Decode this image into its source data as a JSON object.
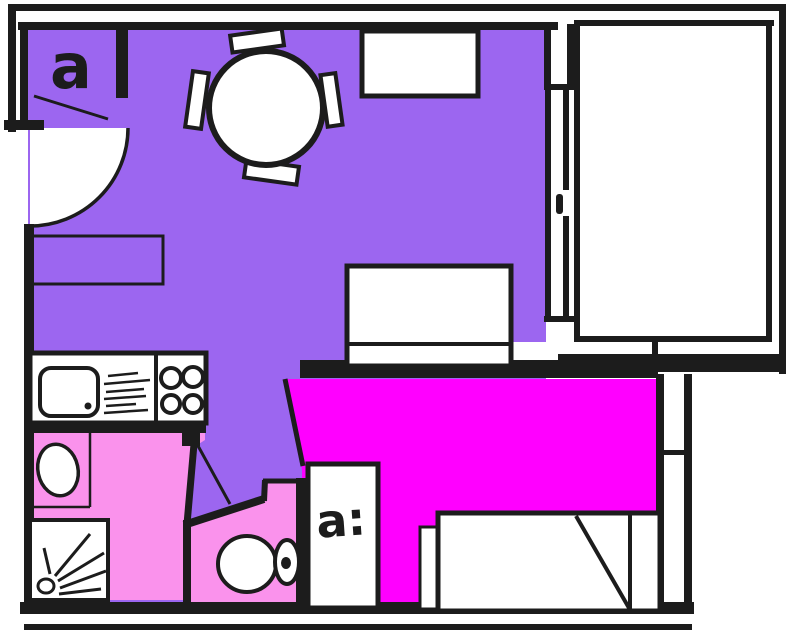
{
  "meta": {
    "kind": "hand-drawn studio apartment floor plan",
    "canvas": {
      "width": 800,
      "height": 641
    }
  },
  "colors": {
    "living_area": "#9C66F0",
    "sleeping_area": "#FF00FF",
    "wet_rooms": "#FA92EC",
    "walls_ink": "#1C1C1C",
    "furniture_fill": "#FFFFFF",
    "background": "#FFFFFF"
  },
  "labels": {
    "entry_closet": "a",
    "bedroom_closet": "a:"
  },
  "symbols": [
    {
      "name": "entry-door-swing-arc"
    },
    {
      "name": "entry-coat-closet"
    },
    {
      "name": "round-dining-table"
    },
    {
      "name": "dining-chair"
    },
    {
      "name": "wall-cabinet"
    },
    {
      "name": "sideboard"
    },
    {
      "name": "sofa"
    },
    {
      "name": "balcony"
    },
    {
      "name": "sliding-window-door"
    },
    {
      "name": "kitchen-sink"
    },
    {
      "name": "drainboard-hatching"
    },
    {
      "name": "stove-burners"
    },
    {
      "name": "washbasin"
    },
    {
      "name": "shower-tray"
    },
    {
      "name": "shower-spray"
    },
    {
      "name": "toilet"
    },
    {
      "name": "wardrobe"
    },
    {
      "name": "bed"
    },
    {
      "name": "bedside-table"
    }
  ]
}
